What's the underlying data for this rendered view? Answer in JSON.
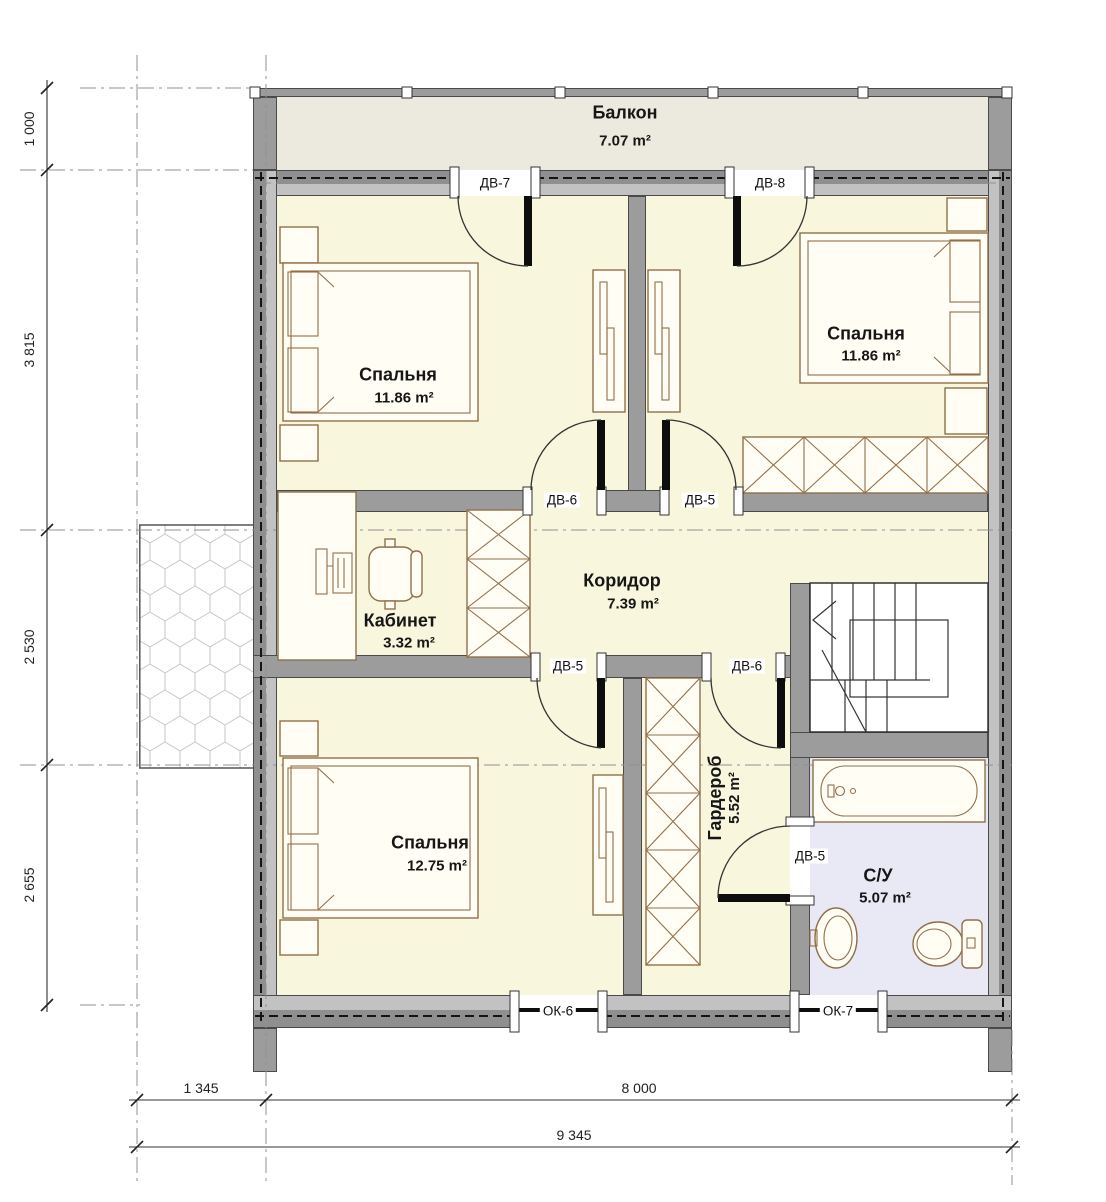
{
  "rooms": {
    "balcony": {
      "name": "Балкон",
      "area": "7.07 m²"
    },
    "bedroom_top_left": {
      "name": "Спальня",
      "area": "11.86 m²"
    },
    "bedroom_top_right": {
      "name": "Спальня",
      "area": "11.86 m²"
    },
    "corridor": {
      "name": "Коридор",
      "area": "7.39 m²"
    },
    "office": {
      "name": "Кабинет",
      "area": "3.32 m²"
    },
    "bedroom_bottom": {
      "name": "Спальня",
      "area": "12.75 m²"
    },
    "wardrobe": {
      "name": "Гардероб",
      "area": "5.52 m²"
    },
    "bathroom": {
      "name": "С/У",
      "area": "5.07 m²"
    }
  },
  "doors": {
    "dv7": "ДВ-7",
    "dv8": "ДВ-8",
    "dv6_top": "ДВ-6",
    "dv5_top": "ДВ-5",
    "dv5_bottom": "ДВ-5",
    "dv6_bottom": "ДВ-6",
    "dv5_bath": "ДВ-5"
  },
  "windows": {
    "ok6": "ОК-6",
    "ok7": "ОК-7"
  },
  "dimensions": {
    "left": {
      "d1": "1 000",
      "d2": "3 815",
      "d3": "2 530",
      "d4": "2 655"
    },
    "bottom": {
      "d1": "1 345",
      "d2": "8 000",
      "total": "9 345"
    }
  },
  "colors": {
    "wall": "#9c9c9c",
    "wall_dark": "#4a4a4a",
    "room": "#f8f6dd",
    "balcony": "#ece9df",
    "bath": "#e9e9f6",
    "furniture": "#926f49",
    "line": "#222222"
  }
}
